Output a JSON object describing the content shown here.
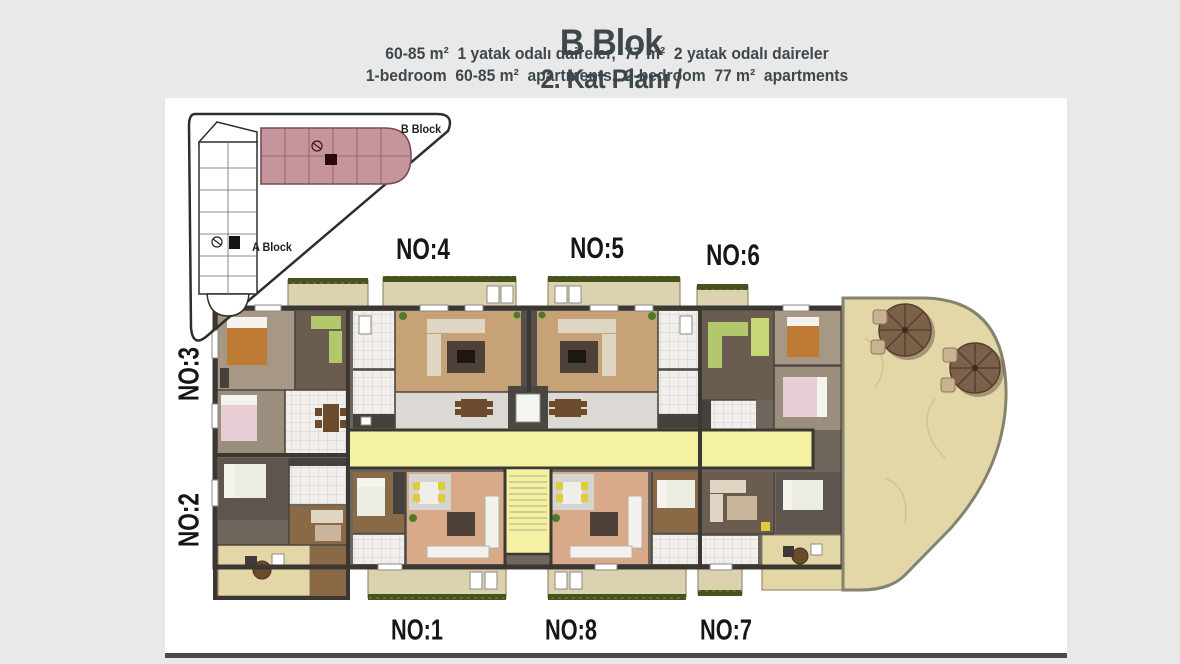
{
  "header": {
    "title_tr_main": "B Blok",
    "title_tr_sub": "2. Kat Planı /",
    "title_en_main": "Block B",
    "title_en_sub": "2. Floor Plan",
    "subtitle_tr": "60-85 m²  1 yatak odalı daireler,  77 m²  2 yatak odalı daireler",
    "subtitle_en": "1-bedroom  60-85 m²  apartments,  2-bedroom  77 m²  apartments"
  },
  "site_inset": {
    "b_block_label": "B Block",
    "a_block_label": "A Block"
  },
  "units": {
    "no1": "NO:1",
    "no2": "NO:2",
    "no3": "NO:3",
    "no4": "NO:4",
    "no5": "NO:5",
    "no6": "NO:6",
    "no7": "NO:7",
    "no8": "NO:8"
  },
  "icons": {
    "umbrella-icon": "parasol top view (8 segments)",
    "staircase": "stair treads",
    "elevator": "elevator car in shaft"
  },
  "colors": {
    "page_bg": "#e9e9e9",
    "panel_bg": "#ffffff",
    "title_text": "#3e474c",
    "label_text": "#161616",
    "wall": "#3b3833",
    "corridor_yellow": "#f5f1a3",
    "balcony_beige": "#ddd2b0",
    "planter_green": "#46531e",
    "terrace_beige": "#e3d6a7",
    "terrace_border": "#85826f",
    "b_block_pink": "#c5949c",
    "b_block_outline": "#7b4b53",
    "wood_tan": "#c8a277",
    "wood_brown": "#8a6a46",
    "wood_dark": "#6b5c50",
    "salmon_floor": "#d9aa8a",
    "tile_white": "#f1efec",
    "sofa_green": "#b3c76c",
    "bed_orange": "#bf7a33",
    "bed_pink": "#e6ced4",
    "chair_yellow": "#e0ca3e",
    "umbrella_brown": "#7d604a"
  }
}
